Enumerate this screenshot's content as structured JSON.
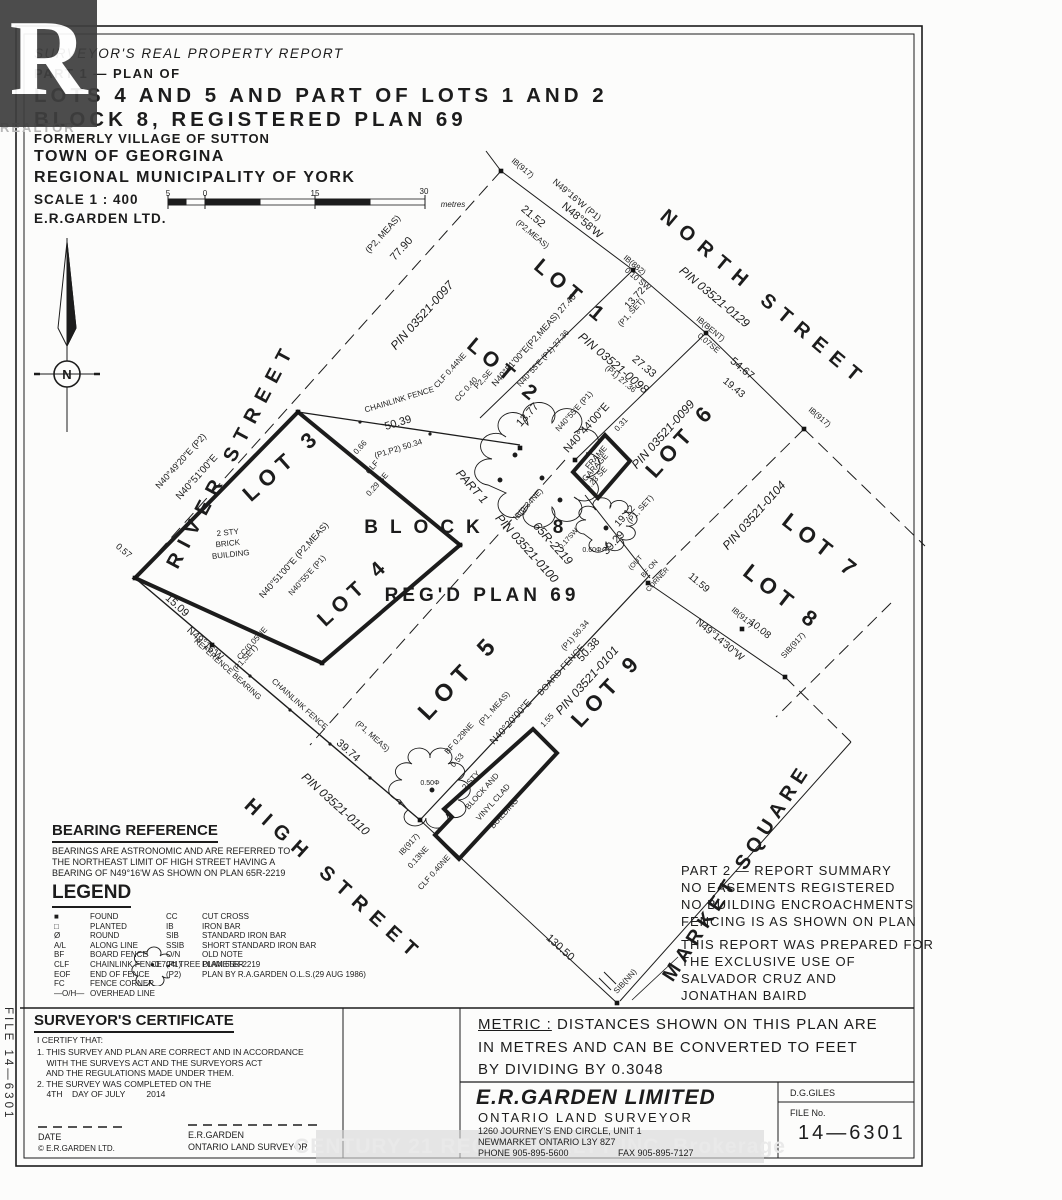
{
  "sheet": {
    "file_side_label": "FILE 14—6301",
    "watermark_r": "R",
    "watermark_realtor": "REALTOR",
    "watermark_banner": "CENTURY 21 REGAL REALTY INC. Brokerage",
    "ink_color": "#1c1c1c"
  },
  "title_block": {
    "line1": "SURVEYOR'S REAL PROPERTY REPORT",
    "line2": "PART 1 — PLAN OF",
    "line3": "LOTS 4 AND 5 AND PART OF LOTS 1 AND 2",
    "line4": "BLOCK 8, REGISTERED PLAN 69",
    "line5": "FORMERLY VILLAGE OF SUTTON",
    "line6": "TOWN OF GEORGINA",
    "line7": "REGIONAL MUNICIPALITY OF YORK",
    "scale_label": "SCALE 1 : 400",
    "firm": "E.R.GARDEN LTD."
  },
  "bearing_reference": {
    "heading": "BEARING REFERENCE",
    "lines": [
      "BEARINGS ARE ASTRONOMIC AND ARE REFERRED TO",
      "THE NORTHEAST LIMIT OF HIGH STREET HAVING A",
      "BEARING OF N49°16'W AS SHOWN ON PLAN 65R-2219"
    ]
  },
  "legend": {
    "heading": "LEGEND",
    "left": [
      {
        "sym": "■",
        "label": "FOUND"
      },
      {
        "sym": "□",
        "label": "PLANTED"
      },
      {
        "sym": "Ø",
        "label": "ROUND"
      },
      {
        "sym": "A/L",
        "label": "ALONG LINE"
      },
      {
        "sym": "BF",
        "label": "BOARD FENCE"
      },
      {
        "sym": "CLF",
        "label": "CHAINLINK FENCE"
      },
      {
        "sym": "EOF",
        "label": "END OF FENCE"
      },
      {
        "sym": "FC",
        "label": "FENCE CORNER"
      },
      {
        "sym": "—O/H—",
        "label": "OVERHEAD LINE"
      }
    ],
    "right": [
      {
        "sym": "CC",
        "label": "CUT CROSS"
      },
      {
        "sym": "IB",
        "label": "IRON BAR"
      },
      {
        "sym": "SIB",
        "label": "STANDARD IRON BAR"
      },
      {
        "sym": "SSIB",
        "label": "SHORT STANDARD IRON BAR"
      },
      {
        "sym": "O/N",
        "label": "OLD NOTE"
      },
      {
        "sym": "(P1)",
        "label": "PLAN 65R-2219"
      },
      {
        "sym": "(P2)",
        "label": "PLAN BY R.A.GARDEN O.L.S.(29 AUG 1986)"
      }
    ],
    "tree_note": "●0.70Φ   TREE DIAMETER"
  },
  "part2": {
    "summary": [
      "PART 2 — REPORT SUMMARY",
      "NO EASEMENTS REGISTERED",
      "NO BUILDING ENCROACHMENTS",
      "FENCING IS AS SHOWN ON PLAN"
    ],
    "prepared": [
      "THIS REPORT WAS PREPARED FOR",
      "THE EXCLUSIVE USE OF",
      "SALVADOR CRUZ AND",
      "JONATHAN BAIRD"
    ]
  },
  "certificate": {
    "heading": "SURVEYOR'S CERTIFICATE",
    "intro": "I CERTIFY THAT:",
    "items": [
      "1. THIS SURVEY AND PLAN ARE CORRECT AND IN ACCORDANCE",
      "    WITH THE SURVEYS ACT AND THE SURVEYORS ACT",
      "    AND THE REGULATIONS MADE UNDER THEM.",
      "2. THE SURVEY WAS COMPLETED ON THE",
      "    4TH    DAY OF JULY         2014"
    ],
    "date_label": "DATE",
    "copyright": "©  E.R.GARDEN LTD.",
    "signer": "E.R.GARDEN",
    "signer_title": "ONTARIO LAND SURVEYOR"
  },
  "metric_note": {
    "label": "METRIC :",
    "line1_rest": "  DISTANCES SHOWN ON THIS PLAN ARE",
    "line2": "IN METRES AND CAN BE CONVERTED TO FEET",
    "line3": "BY DIVIDING BY 0.3048"
  },
  "company_block": {
    "name": "E.R.GARDEN LIMITED",
    "title": "ONTARIO LAND SURVEYOR",
    "addr1": "1260 JOURNEY'S END CIRCLE, UNIT 1",
    "addr2": "NEWMARKET ONTARIO   L3Y 8Z7",
    "phone": "PHONE 905-895-5600",
    "fax": "FAX 905-895-7127",
    "checker": "D.G.GILES",
    "file_label": "FILE No.",
    "file_no": "14—6301"
  },
  "plan": {
    "labels": [
      {
        "t": "RIVER STREET",
        "x": 237,
        "y": 458,
        "r": -62,
        "s": 20,
        "ls": 9,
        "b": 1
      },
      {
        "t": "NORTH STREET",
        "x": 760,
        "y": 303,
        "r": 40,
        "s": 20,
        "ls": 9,
        "b": 1
      },
      {
        "t": "HIGH STREET",
        "x": 330,
        "y": 885,
        "r": 42,
        "s": 20,
        "ls": 9,
        "b": 1
      },
      {
        "t": "MARKET SQUARE",
        "x": 742,
        "y": 876,
        "r": -57,
        "s": 20,
        "ls": 6,
        "b": 1
      },
      {
        "t": "LOT 3",
        "x": 287,
        "y": 470,
        "r": -42,
        "s": 22,
        "ls": 7,
        "b": 1
      },
      {
        "t": "LOT 4",
        "x": 358,
        "y": 597,
        "r": -43,
        "s": 21,
        "ls": 6,
        "b": 1
      },
      {
        "t": "LOT 5",
        "x": 465,
        "y": 682,
        "r": -47,
        "s": 24,
        "ls": 8,
        "b": 1
      },
      {
        "t": "LOT 1",
        "x": 567,
        "y": 297,
        "r": 40,
        "s": 21,
        "ls": 6,
        "b": 1
      },
      {
        "t": "LOT 2",
        "x": 500,
        "y": 376,
        "r": 40,
        "s": 21,
        "ls": 6,
        "b": 1
      },
      {
        "t": "LOT 6",
        "x": 686,
        "y": 445,
        "r": -48,
        "s": 22,
        "ls": 6,
        "b": 1
      },
      {
        "t": "LOT 7",
        "x": 817,
        "y": 552,
        "r": 38,
        "s": 22,
        "ls": 6,
        "b": 1
      },
      {
        "t": "LOT 8",
        "x": 778,
        "y": 603,
        "r": 38,
        "s": 22,
        "ls": 6,
        "b": 1
      },
      {
        "t": "LOT 9",
        "x": 612,
        "y": 695,
        "r": -47,
        "s": 22,
        "ls": 6,
        "b": 1
      },
      {
        "t": "BLOCK",
        "x": 428,
        "y": 533,
        "r": 0,
        "s": 19,
        "ls": 12,
        "b": 1
      },
      {
        "t": "8",
        "x": 558,
        "y": 533,
        "r": 0,
        "s": 19,
        "b": 1
      },
      {
        "t": "REG'D  PLAN  69",
        "x": 482,
        "y": 601,
        "r": 0,
        "s": 19,
        "ls": 4,
        "b": 1
      },
      {
        "t": "PIN 03521-0097",
        "x": 425,
        "y": 318,
        "r": -48,
        "s": 12,
        "i": 1
      },
      {
        "t": "PIN 03521-0129",
        "x": 712,
        "y": 300,
        "r": 40,
        "s": 12,
        "i": 1
      },
      {
        "t": "PIN 03521-0098",
        "x": 611,
        "y": 366,
        "r": 40,
        "s": 12,
        "i": 1
      },
      {
        "t": "PIN 03521-0099",
        "x": 666,
        "y": 437,
        "r": -48,
        "s": 12,
        "i": 1
      },
      {
        "t": "PIN 03521-0104",
        "x": 757,
        "y": 518,
        "r": -48,
        "s": 12,
        "i": 1
      },
      {
        "t": "PIN 03521-0100",
        "x": 524,
        "y": 551,
        "r": 48,
        "s": 12,
        "i": 1
      },
      {
        "t": "PART 1",
        "x": 469,
        "y": 489,
        "r": 48,
        "s": 12,
        "i": 1
      },
      {
        "t": "65R-2219",
        "x": 550,
        "y": 546,
        "r": 48,
        "s": 12,
        "i": 1
      },
      {
        "t": "PIN 03521-0110",
        "x": 333,
        "y": 807,
        "r": 42,
        "s": 12,
        "i": 1
      },
      {
        "t": "PIN 03521-0101",
        "x": 590,
        "y": 683,
        "r": -48,
        "s": 12,
        "i": 1
      },
      {
        "t": "(P2, MEAS)",
        "x": 385,
        "y": 236,
        "r": -48,
        "s": 9
      },
      {
        "t": "77.90",
        "x": 404,
        "y": 251,
        "r": -48,
        "s": 11
      },
      {
        "t": "N40°49'20\"E (P2)",
        "x": 183,
        "y": 463,
        "r": -48,
        "s": 9
      },
      {
        "t": "N40°51'00\"E",
        "x": 199,
        "y": 479,
        "r": -48,
        "s": 10
      },
      {
        "t": "N40°51'00\"E (P2,MEAS)",
        "x": 296,
        "y": 562,
        "r": -48,
        "s": 9
      },
      {
        "t": "N40°55'E  (P1)",
        "x": 309,
        "y": 577,
        "r": -48,
        "s": 8
      },
      {
        "t": "0.57",
        "x": 122,
        "y": 553,
        "r": 40,
        "s": 9
      },
      {
        "t": "15.09",
        "x": 175,
        "y": 608,
        "r": 42,
        "s": 11
      },
      {
        "t": "N49°16'W",
        "x": 203,
        "y": 646,
        "r": 42,
        "s": 10
      },
      {
        "t": "REFERENCE BEARING",
        "x": 226,
        "y": 671,
        "r": 42,
        "s": 8
      },
      {
        "t": "CC(0.05NE",
        "x": 254,
        "y": 645,
        "r": -48,
        "s": 8
      },
      {
        "t": "(P1,SET)",
        "x": 247,
        "y": 660,
        "r": -48,
        "s": 8
      },
      {
        "t": "CHAINLINK FENCE",
        "x": 298,
        "y": 706,
        "r": 42,
        "s": 8
      },
      {
        "t": "(P1, MEAS)",
        "x": 371,
        "y": 738,
        "r": 42,
        "s": 8
      },
      {
        "t": "39.74",
        "x": 346,
        "y": 753,
        "r": 42,
        "s": 11
      },
      {
        "t": "IB(917)",
        "x": 411,
        "y": 846,
        "r": -48,
        "s": 8
      },
      {
        "t": "0.13NE",
        "x": 420,
        "y": 859,
        "r": -48,
        "s": 8
      },
      {
        "t": "CLF 0.40NE",
        "x": 436,
        "y": 874,
        "r": -48,
        "s": 8
      },
      {
        "t": "130.50",
        "x": 558,
        "y": 950,
        "r": 42,
        "s": 11
      },
      {
        "t": "SIB(NN)",
        "x": 627,
        "y": 983,
        "r": -48,
        "s": 8
      },
      {
        "t": "CHAINLINK FENCE",
        "x": 400,
        "y": 402,
        "r": -17,
        "s": 8
      },
      {
        "t": "50.39",
        "x": 399,
        "y": 426,
        "r": -17,
        "s": 11
      },
      {
        "t": "(P1,P2) 50.34",
        "x": 399,
        "y": 451,
        "r": -17,
        "s": 8
      },
      {
        "t": "CLF",
        "x": 374,
        "y": 469,
        "r": -48,
        "s": 8
      },
      {
        "t": "0.29 SE",
        "x": 379,
        "y": 486,
        "r": -48,
        "s": 8
      },
      {
        "t": "0.66",
        "x": 362,
        "y": 449,
        "r": -48,
        "s": 8
      },
      {
        "t": "CLF 0.44NE",
        "x": 452,
        "y": 372,
        "r": -48,
        "s": 8
      },
      {
        "t": "CC 0.40",
        "x": 468,
        "y": 391,
        "r": -48,
        "s": 8
      },
      {
        "t": "P2,SE",
        "x": 485,
        "y": 381,
        "r": -48,
        "s": 8
      },
      {
        "t": "13.77",
        "x": 530,
        "y": 417,
        "r": -48,
        "s": 11
      },
      {
        "t": "IB(0.34NE)",
        "x": 530,
        "y": 506,
        "r": -48,
        "s": 8
      },
      {
        "t": "2 STY",
        "x": 228,
        "y": 535,
        "r": -6,
        "s": 8
      },
      {
        "t": "BRICK",
        "x": 228,
        "y": 546,
        "r": -6,
        "s": 8
      },
      {
        "t": "BUILDING",
        "x": 231,
        "y": 557,
        "r": -6,
        "s": 8
      },
      {
        "t": "2 STY",
        "x": 473,
        "y": 782,
        "r": -48,
        "s": 8
      },
      {
        "t": "BLOCK AND",
        "x": 484,
        "y": 793,
        "r": -48,
        "s": 8
      },
      {
        "t": "VINYL CLAD",
        "x": 495,
        "y": 804,
        "r": -48,
        "s": 8
      },
      {
        "t": "BUILDING",
        "x": 506,
        "y": 815,
        "r": -48,
        "s": 8
      },
      {
        "t": "BF 0.29NE",
        "x": 461,
        "y": 740,
        "r": -48,
        "s": 8
      },
      {
        "t": "0.53",
        "x": 459,
        "y": 762,
        "r": -48,
        "s": 8
      },
      {
        "t": "1.55",
        "x": 549,
        "y": 722,
        "r": -48,
        "s": 8
      },
      {
        "t": "(P1, MEAS)",
        "x": 496,
        "y": 710,
        "r": -48,
        "s": 8
      },
      {
        "t": "N40°20'00\"E",
        "x": 513,
        "y": 724,
        "r": -48,
        "s": 10
      },
      {
        "t": "BOARD FENCE",
        "x": 563,
        "y": 672,
        "r": -48,
        "s": 9
      },
      {
        "t": "(P1) 50.34",
        "x": 577,
        "y": 637,
        "r": -48,
        "s": 8
      },
      {
        "t": "50.38",
        "x": 591,
        "y": 652,
        "r": -48,
        "s": 11
      },
      {
        "t": "FRAME",
        "x": 598,
        "y": 459,
        "r": -48,
        "s": 8
      },
      {
        "t": "GARAGE",
        "x": 597,
        "y": 469,
        "r": -48,
        "s": 8
      },
      {
        "t": "0.23 SE",
        "x": 598,
        "y": 480,
        "r": -48,
        "s": 8
      },
      {
        "t": "0.31",
        "x": 623,
        "y": 426,
        "r": -48,
        "s": 8
      },
      {
        "t": "N40°55'E (P1)",
        "x": 576,
        "y": 413,
        "r": -48,
        "s": 8
      },
      {
        "t": "N40°44'00\"E",
        "x": 589,
        "y": 430,
        "r": -48,
        "s": 11
      },
      {
        "t": "(P1) 27.36",
        "x": 619,
        "y": 381,
        "r": 40,
        "s": 8
      },
      {
        "t": "27.33",
        "x": 642,
        "y": 369,
        "r": 40,
        "s": 11
      },
      {
        "t": "0.17SW",
        "x": 570,
        "y": 540,
        "r": -48,
        "s": 7
      },
      {
        "t": "0.60Φ",
        "x": 592,
        "y": 552,
        "r": 0,
        "s": 7
      },
      {
        "t": "19.12",
        "x": 627,
        "y": 518,
        "r": -48,
        "s": 10
      },
      {
        "t": "(P1, SET)",
        "x": 642,
        "y": 511,
        "r": -48,
        "s": 8
      },
      {
        "t": "39.29",
        "x": 616,
        "y": 545,
        "r": -48,
        "s": 11
      },
      {
        "t": "(OUT",
        "x": 637,
        "y": 564,
        "r": -48,
        "s": 7
      },
      {
        "t": "BF ON",
        "x": 651,
        "y": 570,
        "r": -48,
        "s": 7
      },
      {
        "t": "CORNER",
        "x": 659,
        "y": 581,
        "r": -48,
        "s": 7
      },
      {
        "t": "IB(917)",
        "x": 521,
        "y": 170,
        "r": 40,
        "s": 8
      },
      {
        "t": "N49°16'W (P1)",
        "x": 575,
        "y": 202,
        "r": 40,
        "s": 9
      },
      {
        "t": "N48°58'W",
        "x": 580,
        "y": 223,
        "r": 40,
        "s": 11
      },
      {
        "t": "21.52",
        "x": 531,
        "y": 219,
        "r": 40,
        "s": 11
      },
      {
        "t": "(P2,MEAS)",
        "x": 531,
        "y": 236,
        "r": 40,
        "s": 8
      },
      {
        "t": "IB(882)",
        "x": 633,
        "y": 267,
        "r": 40,
        "s": 8
      },
      {
        "t": "0.10 SW",
        "x": 636,
        "y": 281,
        "r": 40,
        "s": 8
      },
      {
        "t": "13.72",
        "x": 637,
        "y": 300,
        "r": -48,
        "s": 10
      },
      {
        "t": "(P1, SET)",
        "x": 633,
        "y": 314,
        "r": -48,
        "s": 8
      },
      {
        "t": "IB(BENT)",
        "x": 709,
        "y": 331,
        "r": 40,
        "s": 8
      },
      {
        "t": "0.07SE",
        "x": 707,
        "y": 345,
        "r": 40,
        "s": 8
      },
      {
        "t": "54.67",
        "x": 740,
        "y": 371,
        "r": 40,
        "s": 11
      },
      {
        "t": "19.43",
        "x": 732,
        "y": 390,
        "r": 40,
        "s": 10
      },
      {
        "t": "IB(917)",
        "x": 818,
        "y": 419,
        "r": 40,
        "s": 8
      },
      {
        "t": "N40°51'00\"E(P2,MEAS) 27.40",
        "x": 536,
        "y": 342,
        "r": -48,
        "s": 9
      },
      {
        "t": "N40°55'E (P1) 27.36",
        "x": 545,
        "y": 360,
        "r": -48,
        "s": 8
      },
      {
        "t": "11.59",
        "x": 697,
        "y": 585,
        "r": 40,
        "s": 10
      },
      {
        "t": "IB(917)",
        "x": 741,
        "y": 619,
        "r": 40,
        "s": 8
      },
      {
        "t": "10.08",
        "x": 758,
        "y": 631,
        "r": 40,
        "s": 10
      },
      {
        "t": "N49°14'30\"W",
        "x": 718,
        "y": 642,
        "r": 40,
        "s": 10
      },
      {
        "t": "SIB(917)",
        "x": 795,
        "y": 647,
        "r": -48,
        "s": 8
      },
      {
        "t": "0.50Φ",
        "x": 430,
        "y": 785,
        "r": 0,
        "s": 7
      },
      {
        "t": "5",
        "x": 168,
        "y": 196,
        "r": 0,
        "s": 8
      },
      {
        "t": "0",
        "x": 205,
        "y": 196,
        "r": 0,
        "s": 8
      },
      {
        "t": "15",
        "x": 315,
        "y": 196,
        "r": 0,
        "s": 8
      },
      {
        "t": "30",
        "x": 424,
        "y": 194,
        "r": 0,
        "s": 8
      },
      {
        "t": "metres",
        "x": 453,
        "y": 207,
        "r": 0,
        "s": 8,
        "i": 1
      },
      {
        "t": "N",
        "x": 67,
        "y": 379,
        "r": 0,
        "s": 13,
        "b": 1
      }
    ],
    "markers": [
      [
        501,
        171
      ],
      [
        633,
        270
      ],
      [
        706,
        333
      ],
      [
        804,
        429
      ],
      [
        135,
        578
      ],
      [
        212,
        645
      ],
      [
        420,
        820
      ],
      [
        648,
        583
      ],
      [
        742,
        629
      ],
      [
        785,
        677
      ],
      [
        617,
        1003
      ],
      [
        298,
        412
      ],
      [
        460,
        545
      ],
      [
        322,
        663
      ],
      [
        520,
        448
      ],
      [
        575,
        460
      ]
    ]
  }
}
